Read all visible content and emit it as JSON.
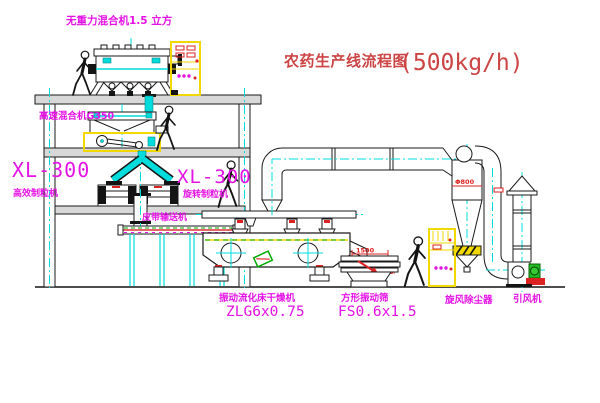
{
  "title": {
    "text": "农药生产线流程图",
    "capacity": "(500kg/h)"
  },
  "annotations": {
    "top_mixer": "无重力混合机1.5 立方",
    "high_speed_mixer": "高速混合机G350",
    "left_granulator_model": "XL-300",
    "left_granulator_name": "高效制粒机",
    "mid_granulator_model": "XL-300",
    "mid_granulator_name": "旋转制粒机",
    "belt_conveyor": "皮带输送机",
    "dryer_name": "振动流化床干燥机",
    "dryer_model": "ZLG6x0.75",
    "sieve_name": "方形振动筛",
    "sieve_model": "FS0.6x1.5",
    "cyclone_name": "旋风除尘器",
    "fan_name": "引风机"
  },
  "dimensions": {
    "cyclone": "Φ800",
    "sieve_width": "1500",
    "sieve_height": "545"
  },
  "colors": {
    "label_magenta": "#e512e5",
    "centerline_cyan": "#00dcdc",
    "title_red": "#cc4444",
    "dimension_red": "#dd2222",
    "cabinet_yellow": "#f0d800",
    "accent_green": "#00aa00",
    "line_black": "#1a1a1a"
  }
}
